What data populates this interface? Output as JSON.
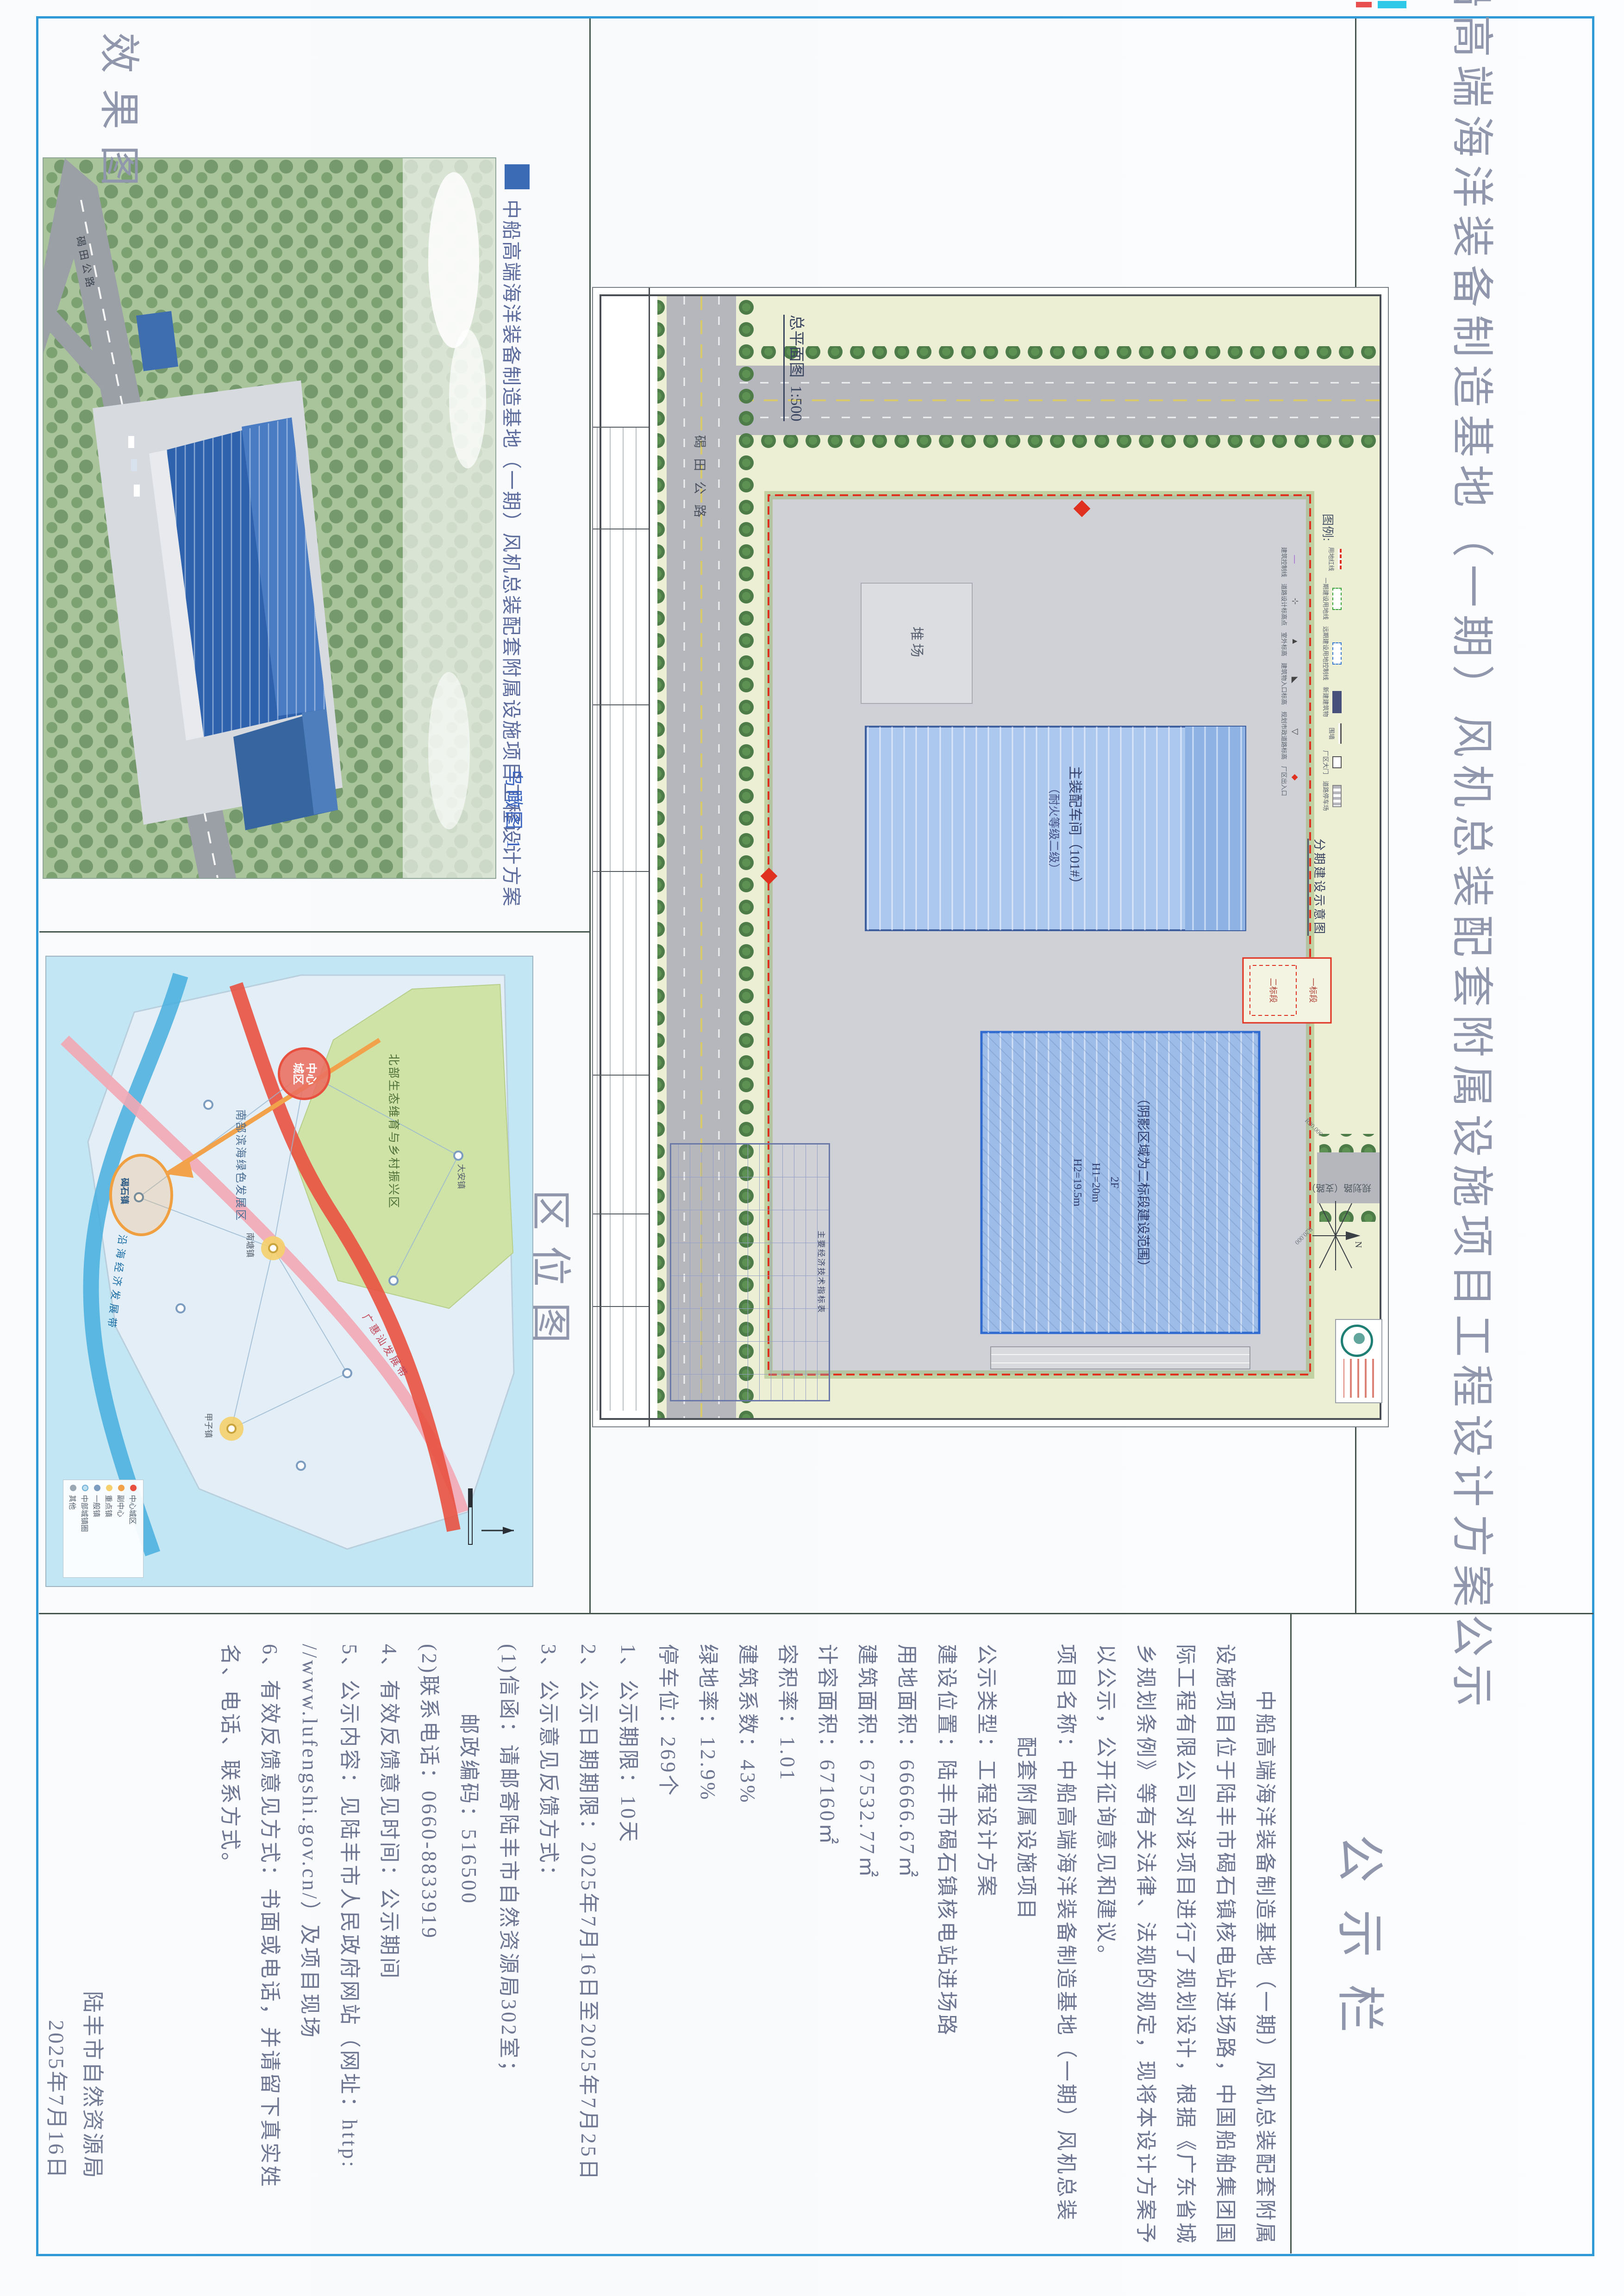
{
  "title": "中船高端海洋装备制造基地（一期）风机总装配套附属设施项目工程设计方案公示",
  "notice": {
    "header": "公示栏",
    "lines": [
      "　　中船高端海洋装备制造基地（一期）风机总装配套附属",
      "设施项目位于陆丰市碣石镇核电站进场路，中国船舶集团国",
      "际工程有限公司对该项目进行了规划设计，根据《广东省城",
      "乡规划条例》等有关法律、法规的规定，现将本设计方案予",
      "以公示，公开征询意见和建议。",
      "项目名称：中船高端海洋装备制造基地（一期）风机总装",
      "　　　　配套附属设施项目",
      "公示类型：工程设计方案",
      "建设位置：陆丰市碣石镇核电站进场路",
      "用地面积：66666.67㎡",
      "建筑面积：67532.77㎡",
      "计容面积：67160㎡",
      "容积率：1.01",
      "建筑系数：43%",
      "绿地率：12.9%",
      "停车位：269个",
      "1、公示期限：10天",
      "2、公示日期期限：2025年7月16日至2025年7月25日",
      "3、公示意见反馈方式：",
      "(1)信函：请邮寄陆丰市自然资源局302室；",
      "　　　邮政编码：516500",
      "(2)联系电话：0660-8833919",
      "4、有效反馈意见时间：公示期间",
      "5、公示内容：见陆丰市人民政府网站（网址：http:",
      "//www.lufengshi.gov.cn/）及项目现场",
      "6、有效反馈意见方式：书面或电话，并请留下真实姓",
      "名、电话、联系方式。"
    ],
    "signature_agency": "陆丰市自然资源局",
    "signature_date": "2025年7月16日"
  },
  "render_panel": {
    "label": "效果图",
    "header_title": "中船高端海洋装备制造基地（一期）风机总装配套附属设施项目工程设计方案",
    "caption": "鸟瞰图 1",
    "road_label": "碣田公路"
  },
  "location_panel": {
    "label": "区位图",
    "center_city": "中心城区",
    "region_north": "北部生态维育与乡村振兴区",
    "region_south": "南部滨海绿色发展区",
    "coast_band": "沿海经济发展带",
    "corridor": "广惠汕发展带",
    "project_town": "碣石镇",
    "town_1": "大安镇",
    "town_2": "南塘镇",
    "town_3": "甲子镇",
    "legend": [
      "中心城区",
      "副中心",
      "重点镇",
      "一般镇",
      "中部城镇圈",
      "其他"
    ],
    "compass": "N"
  },
  "site_plan": {
    "drawing_title": "总平面图",
    "scale": "1:500",
    "legend_title": "图例:",
    "legend_row1": [
      "用地红线",
      "一期建设用地线",
      "远期建设用地控制线",
      "新建建筑物",
      "围墙",
      "厂区大门",
      "道路停车场"
    ],
    "legend_row2": [
      "建筑控制线",
      "道路设计标高点",
      "室外标高",
      "建筑物入口标高",
      "规划市政道路标高",
      "厂区出入口"
    ],
    "phase_title": "分期建设示意图",
    "phase_1": "一标段",
    "phase_2": "二标段",
    "building_a_name": "主装配车间（101#）",
    "building_a_note": "（耐火等级二级）",
    "building_b_note": "（阴影区域为二标段建设范围）",
    "building_b_floors": "2F",
    "building_b_h1": "H1=20m",
    "building_b_h2": "H2=19.5m",
    "yard": "堆场",
    "road": "碣田公路",
    "branch_road": "规划路（支路）",
    "radius_a": "R20.000",
    "radius_b": "R20.000",
    "table_title": "主要经济技术指标表"
  }
}
